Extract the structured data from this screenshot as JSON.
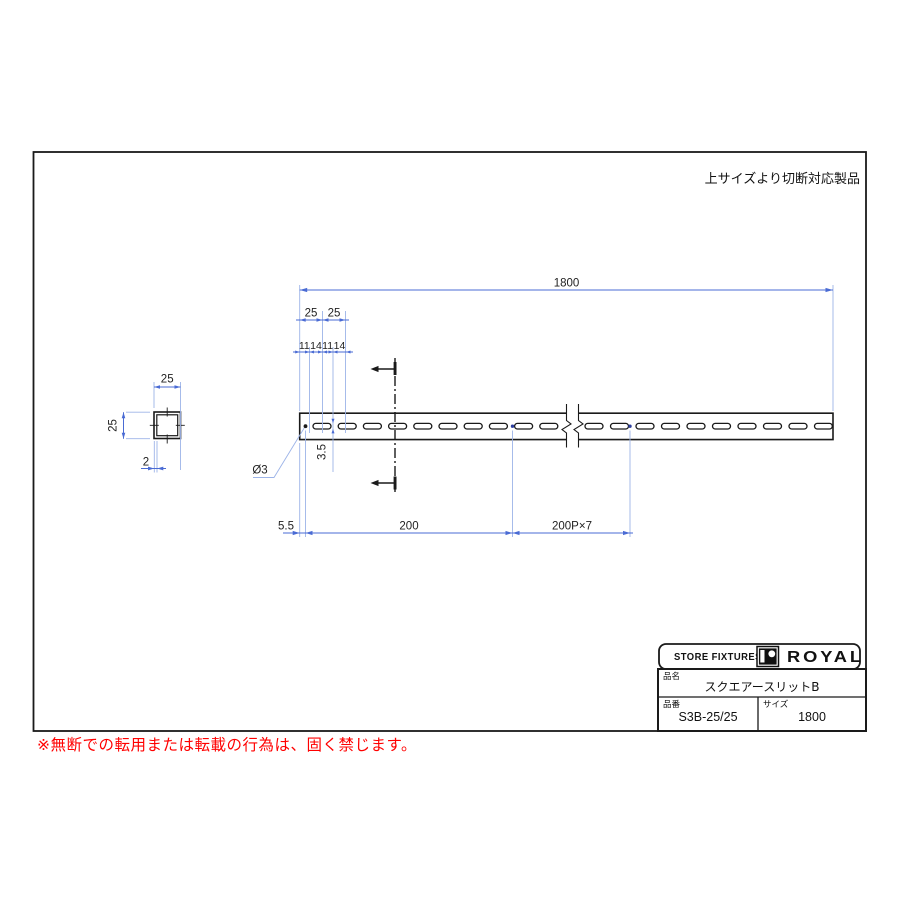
{
  "drawing": {
    "note_top_right": "上サイズより切断対応製品",
    "dims": {
      "overall": "1800",
      "pitch_a": "25",
      "pitch_b": "25",
      "seg1": "11",
      "seg2": "14",
      "seg3": "11",
      "seg4": "14",
      "slit_height": "3.5",
      "hole_dia": "Ø3",
      "end_offset": "5.5",
      "first_pitch": "200",
      "pitch_run": "200P×7",
      "cs_width": "25",
      "cs_height": "25",
      "cs_thickness": "2"
    }
  },
  "title_block": {
    "header_left": "STORE FIXTURES",
    "brand": "ROYAL",
    "name_label": "品名",
    "name_value": "スクエアースリットB",
    "code_label": "品番",
    "code_value": "S3B-25/25",
    "size_label": "サイズ",
    "size_value": "1800"
  },
  "footer": {
    "warning": "※無断での転用または転載の行為は、固く禁じます。"
  },
  "colors": {
    "dimension_line": "#4a6bd4",
    "extension_line": "#9db4e8",
    "ink": "#1a1a1a",
    "warning_red": "#ff0000"
  }
}
